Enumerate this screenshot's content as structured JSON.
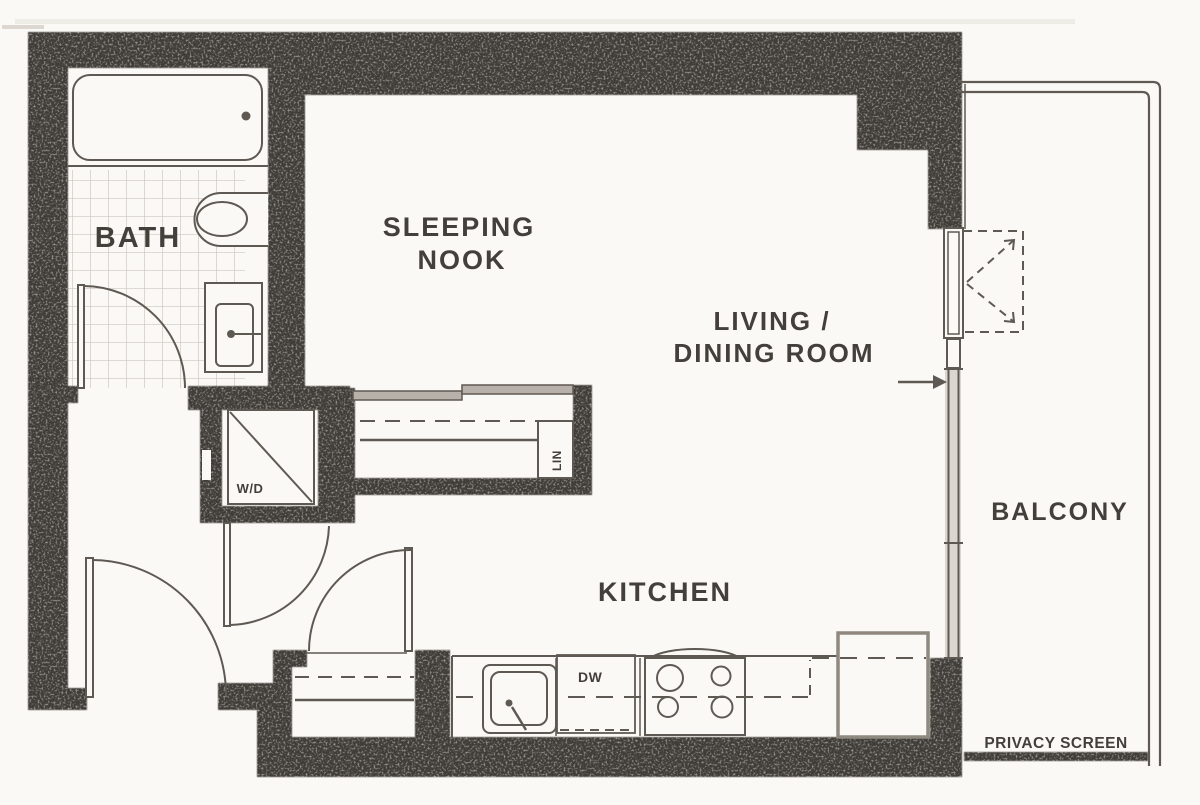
{
  "title": "Studio apartment floor plan",
  "colors": {
    "wall": "#413c38",
    "line": "#5f5953",
    "line_soft": "#8a847c",
    "text": "#433f3b",
    "tile": "#ccc5bc",
    "glass": "#dbd6cf",
    "fridge": "#8f897f",
    "paper": "#fbf9f5"
  },
  "labels": {
    "bath": "BATH",
    "sleeping_1": "SLEEPING",
    "sleeping_2": "NOOK",
    "living_1": "LIVING /",
    "living_2": "DINING ROOM",
    "kitchen": "KITCHEN",
    "balcony": "BALCONY",
    "privacy_screen": "PRIVACY SCREEN",
    "washer_dryer": "W/D",
    "linen": "LIN",
    "dishwasher": "DW"
  }
}
